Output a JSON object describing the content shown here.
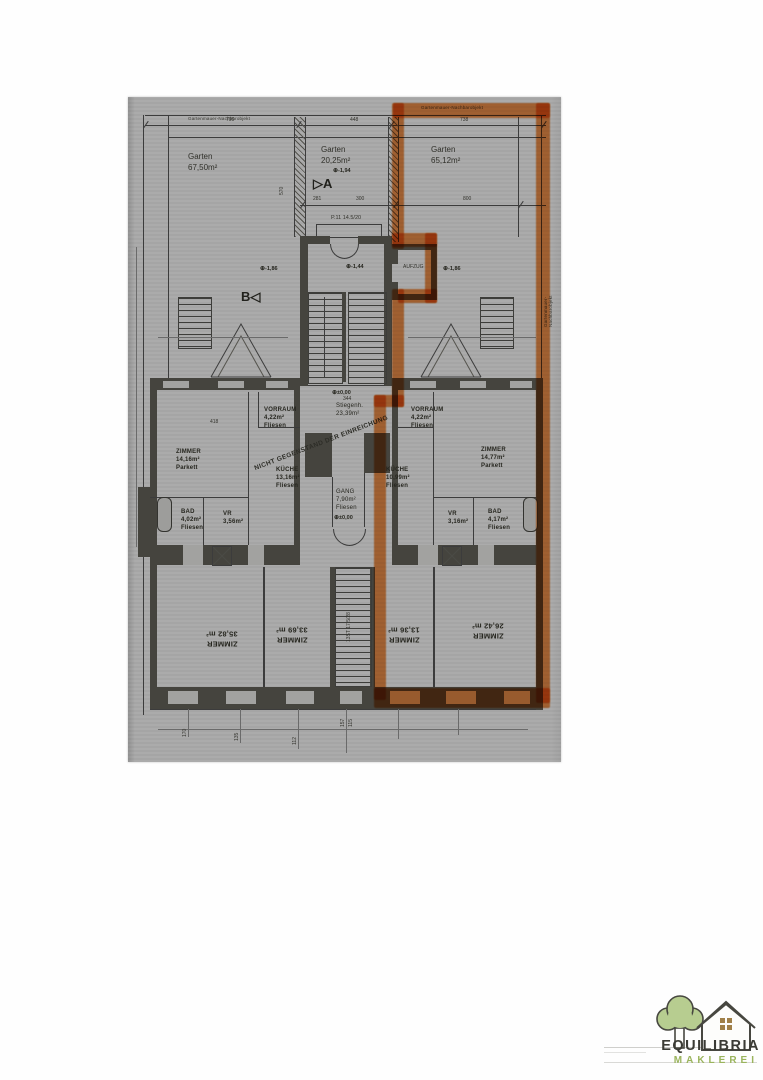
{
  "scan": {
    "bg": "#a9a9a9",
    "ink": "#3c3c3c",
    "wall": "#45443e",
    "highlight": "#ed8030"
  },
  "plan": {
    "boundary_label_left": "Gartenmauer-Nachbarobjekt",
    "boundary_label_right": "Gartenmauer-Nachbarobjekt",
    "boundary_label_side": "Gartenmauer-Nachbarobjekt",
    "gardens": [
      {
        "label": "Garten\n67,50m²"
      },
      {
        "label": "Garten\n20,25m²"
      },
      {
        "label": "Garten\n65,12m²"
      }
    ],
    "section_a": "A",
    "section_b": "B",
    "levels": {
      "l194": "-1,94",
      "l186": "-1,86",
      "l144": "-1,44",
      "zero": "±0,00"
    },
    "stair_note": "P.11 14.5/20",
    "elevator": "AUFZUG",
    "stair_mid": "Stiegenh.\n23,39m²",
    "gang": "GANG\n7,90m²\nFliesen",
    "note_diagonal": "NICHT GEGENSTAND DER EINREICHUNG",
    "stair_bottom": "13ST 17,5/28",
    "rooms": {
      "zimmer_left": "ZIMMER\n14,16m²\nParkett",
      "kueche_left": "KÜCHE\n13,16m²\nFliesen",
      "vorraum_left": "VORRAUM\n4,22m²\nFliesen",
      "bad_left": "BAD\n4,02m²\nFliesen",
      "vr_left": "VR\n3,56m²",
      "vorraum_right": "VORRAUM\n4,22m²\nFliesen",
      "kueche_right": "KÜCHE\n10,99m²\nFliesen",
      "zimmer_right": "ZIMMER\n14,77m²\nParkett",
      "vr_right": "VR\n3,16m²",
      "bad_right": "BAD\n4,17m²\nFliesen",
      "zimmer_b1": "ZIMMER\n35,82 m²",
      "zimmer_b2": "ZIMMER\n33,69 m²",
      "zimmer_b3": "ZIMMER\n13,36 m²",
      "zimmer_b4": "ZIMMER\n26,42 m²"
    },
    "dims": [
      "795",
      "448",
      "738",
      "570",
      "800",
      "418",
      "344",
      "300",
      "281",
      "170",
      "157",
      "115",
      "135",
      "112"
    ]
  },
  "logo": {
    "name": "EQUILIBRIA",
    "sub": "MAKLEREI",
    "green": "#9ab45c",
    "dark": "#3b3b35"
  }
}
